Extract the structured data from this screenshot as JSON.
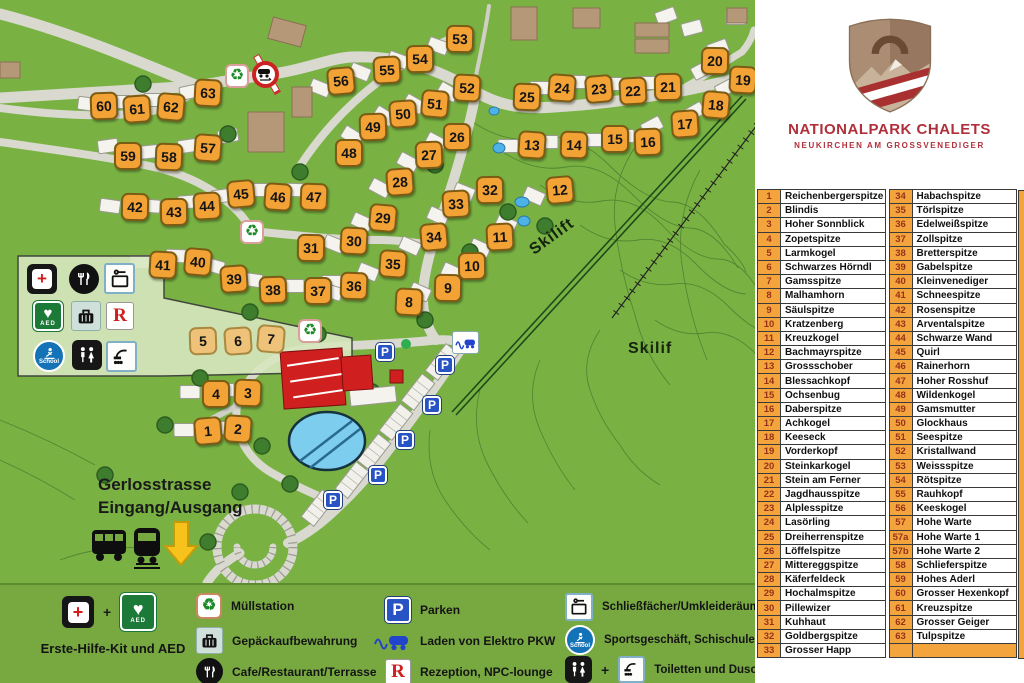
{
  "branding": {
    "title": "NATIONALPARK CHALETS",
    "subtitle": "NEUKIRCHEN AM GROSSVENEDIGER"
  },
  "chalet_table": {
    "left": [
      {
        "num": "1",
        "name": "Reichenbergerspitze"
      },
      {
        "num": "2",
        "name": "Blindis"
      },
      {
        "num": "3",
        "name": "Hoher Sonnblick"
      },
      {
        "num": "4",
        "name": "Zopetspitze"
      },
      {
        "num": "5",
        "name": "Larmkogel"
      },
      {
        "num": "6",
        "name": "Schwarzes Hörndl"
      },
      {
        "num": "7",
        "name": "Gamsspitze"
      },
      {
        "num": "8",
        "name": "Malhamhorn"
      },
      {
        "num": "9",
        "name": "Säulspitze"
      },
      {
        "num": "10",
        "name": "Kratzenberg"
      },
      {
        "num": "11",
        "name": "Kreuzkogel"
      },
      {
        "num": "12",
        "name": "Bachmayrspitze"
      },
      {
        "num": "13",
        "name": "Grossschober"
      },
      {
        "num": "14",
        "name": "Blessachkopf"
      },
      {
        "num": "15",
        "name": "Ochsenbug"
      },
      {
        "num": "16",
        "name": "Daberspitze"
      },
      {
        "num": "17",
        "name": "Achkogel"
      },
      {
        "num": "18",
        "name": "Keeseck"
      },
      {
        "num": "19",
        "name": "Vorderkopf"
      },
      {
        "num": "20",
        "name": "Steinkarkogel"
      },
      {
        "num": "21",
        "name": "Stein am Ferner"
      },
      {
        "num": "22",
        "name": "Jagdhausspitze"
      },
      {
        "num": "23",
        "name": "Alplesspitze"
      },
      {
        "num": "24",
        "name": "Lasörling"
      },
      {
        "num": "25",
        "name": "Dreiherrenspitze"
      },
      {
        "num": "26",
        "name": "Löffelspitze"
      },
      {
        "num": "27",
        "name": "Mittereggspitze"
      },
      {
        "num": "28",
        "name": "Käferfeldeck"
      },
      {
        "num": "29",
        "name": "Hochalmspitze"
      },
      {
        "num": "30",
        "name": "Pillewizer"
      },
      {
        "num": "31",
        "name": "Kuhhaut"
      },
      {
        "num": "32",
        "name": "Goldbergspitze"
      },
      {
        "num": "33",
        "name": "Grosser Happ"
      }
    ],
    "right": [
      {
        "num": "34",
        "name": "Habachspitze"
      },
      {
        "num": "35",
        "name": "Törlspitze"
      },
      {
        "num": "36",
        "name": "Edelweißspitze"
      },
      {
        "num": "37",
        "name": "Zollspitze"
      },
      {
        "num": "38",
        "name": "Bretterspitze"
      },
      {
        "num": "39",
        "name": "Gabelspitze"
      },
      {
        "num": "40",
        "name": "Kleinvenediger"
      },
      {
        "num": "41",
        "name": "Schneespitze"
      },
      {
        "num": "42",
        "name": "Rosenspitze"
      },
      {
        "num": "43",
        "name": "Arventalspitze"
      },
      {
        "num": "44",
        "name": "Schwarze Wand"
      },
      {
        "num": "45",
        "name": "Quirl"
      },
      {
        "num": "46",
        "name": "Rainerhorn"
      },
      {
        "num": "47",
        "name": "Hoher Rosshuf"
      },
      {
        "num": "48",
        "name": "Wildenkogel"
      },
      {
        "num": "49",
        "name": "Gamsmutter"
      },
      {
        "num": "50",
        "name": "Glockhaus"
      },
      {
        "num": "51",
        "name": "Seespitze"
      },
      {
        "num": "52",
        "name": "Kristallwand"
      },
      {
        "num": "53",
        "name": "Weissspitze"
      },
      {
        "num": "54",
        "name": "Rötspitze"
      },
      {
        "num": "55",
        "name": "Rauhkopf"
      },
      {
        "num": "56",
        "name": "Keeskogel"
      },
      {
        "num": "57",
        "name": "Hohe Warte"
      },
      {
        "num": "57a",
        "name": "Hohe Warte 1"
      },
      {
        "num": "57b",
        "name": "Hohe Warte 2"
      },
      {
        "num": "58",
        "name": "Schlieferspitze"
      },
      {
        "num": "59",
        "name": "Hohes Aderl"
      },
      {
        "num": "60",
        "name": "Grosser Hexenkopf"
      },
      {
        "num": "61",
        "name": "Kreuzspitze"
      },
      {
        "num": "62",
        "name": "Grosser Geiger"
      },
      {
        "num": "63",
        "name": "Tulpspitze"
      },
      {
        "num": "",
        "name": ""
      }
    ]
  },
  "map": {
    "labels": {
      "skilift": "Skilift",
      "skilif": "Skilif",
      "street": "Gerlosstrasse",
      "entrance": "Eingang/Ausgang"
    },
    "icons": {
      "recycle": "♻",
      "parking": "P",
      "heart": "♥",
      "aed": "AED",
      "school": "School",
      "reception": "R"
    },
    "muted": [
      "5",
      "6",
      "7"
    ],
    "plots": [
      {
        "n": "1",
        "x": 208,
        "y": 431
      },
      {
        "n": "2",
        "x": 238,
        "y": 429
      },
      {
        "n": "3",
        "x": 248,
        "y": 393
      },
      {
        "n": "4",
        "x": 216,
        "y": 394
      },
      {
        "n": "5",
        "x": 203,
        "y": 341
      },
      {
        "n": "6",
        "x": 238,
        "y": 341
      },
      {
        "n": "7",
        "x": 271,
        "y": 339
      },
      {
        "n": "8",
        "x": 409,
        "y": 302
      },
      {
        "n": "9",
        "x": 448,
        "y": 288
      },
      {
        "n": "10",
        "x": 472,
        "y": 266
      },
      {
        "n": "11",
        "x": 500,
        "y": 237
      },
      {
        "n": "12",
        "x": 560,
        "y": 190
      },
      {
        "n": "13",
        "x": 532,
        "y": 145
      },
      {
        "n": "14",
        "x": 574,
        "y": 145
      },
      {
        "n": "15",
        "x": 615,
        "y": 139
      },
      {
        "n": "16",
        "x": 648,
        "y": 142
      },
      {
        "n": "17",
        "x": 685,
        "y": 124
      },
      {
        "n": "18",
        "x": 716,
        "y": 105
      },
      {
        "n": "19",
        "x": 743,
        "y": 80
      },
      {
        "n": "20",
        "x": 715,
        "y": 61
      },
      {
        "n": "21",
        "x": 668,
        "y": 87
      },
      {
        "n": "22",
        "x": 633,
        "y": 91
      },
      {
        "n": "23",
        "x": 599,
        "y": 89
      },
      {
        "n": "24",
        "x": 562,
        "y": 88
      },
      {
        "n": "25",
        "x": 527,
        "y": 97
      },
      {
        "n": "26",
        "x": 457,
        "y": 137
      },
      {
        "n": "27",
        "x": 429,
        "y": 155
      },
      {
        "n": "28",
        "x": 400,
        "y": 182
      },
      {
        "n": "29",
        "x": 383,
        "y": 218
      },
      {
        "n": "30",
        "x": 354,
        "y": 241
      },
      {
        "n": "31",
        "x": 311,
        "y": 248
      },
      {
        "n": "32",
        "x": 490,
        "y": 190
      },
      {
        "n": "33",
        "x": 456,
        "y": 204
      },
      {
        "n": "34",
        "x": 434,
        "y": 237
      },
      {
        "n": "35",
        "x": 393,
        "y": 264
      },
      {
        "n": "36",
        "x": 354,
        "y": 286
      },
      {
        "n": "37",
        "x": 318,
        "y": 291
      },
      {
        "n": "38",
        "x": 273,
        "y": 290
      },
      {
        "n": "39",
        "x": 234,
        "y": 279
      },
      {
        "n": "40",
        "x": 198,
        "y": 262
      },
      {
        "n": "41",
        "x": 163,
        "y": 265
      },
      {
        "n": "42",
        "x": 135,
        "y": 207
      },
      {
        "n": "43",
        "x": 174,
        "y": 212
      },
      {
        "n": "44",
        "x": 207,
        "y": 206
      },
      {
        "n": "45",
        "x": 241,
        "y": 194
      },
      {
        "n": "46",
        "x": 278,
        "y": 197
      },
      {
        "n": "47",
        "x": 314,
        "y": 197
      },
      {
        "n": "48",
        "x": 349,
        "y": 153
      },
      {
        "n": "49",
        "x": 373,
        "y": 127
      },
      {
        "n": "50",
        "x": 403,
        "y": 114
      },
      {
        "n": "51",
        "x": 435,
        "y": 104
      },
      {
        "n": "52",
        "x": 467,
        "y": 88
      },
      {
        "n": "53",
        "x": 460,
        "y": 39
      },
      {
        "n": "54",
        "x": 420,
        "y": 59
      },
      {
        "n": "55",
        "x": 387,
        "y": 70
      },
      {
        "n": "56",
        "x": 341,
        "y": 81
      },
      {
        "n": "57",
        "x": 208,
        "y": 148
      },
      {
        "n": "58",
        "x": 169,
        "y": 157
      },
      {
        "n": "59",
        "x": 128,
        "y": 156
      },
      {
        "n": "60",
        "x": 104,
        "y": 106
      },
      {
        "n": "61",
        "x": 137,
        "y": 109
      },
      {
        "n": "62",
        "x": 171,
        "y": 107
      },
      {
        "n": "63",
        "x": 208,
        "y": 93
      }
    ],
    "parking": [
      [
        385,
        352
      ],
      [
        445,
        365
      ],
      [
        432,
        405
      ],
      [
        405,
        440
      ],
      [
        378,
        475
      ],
      [
        333,
        500
      ]
    ],
    "recycle": [
      [
        237,
        76
      ],
      [
        252,
        232
      ],
      [
        310,
        331
      ]
    ],
    "chalets": [
      [
        88,
        104,
        8
      ],
      [
        120,
        102,
        0
      ],
      [
        154,
        100,
        0
      ],
      [
        190,
        92,
        -12
      ],
      [
        108,
        146,
        -8
      ],
      [
        148,
        152,
        -6
      ],
      [
        188,
        146,
        -8
      ],
      [
        228,
        136,
        -10
      ],
      [
        320,
        88,
        22
      ],
      [
        360,
        72,
        22
      ],
      [
        398,
        60,
        20
      ],
      [
        438,
        46,
        20
      ],
      [
        352,
        136,
        32
      ],
      [
        384,
        116,
        32
      ],
      [
        414,
        104,
        30
      ],
      [
        448,
        92,
        30
      ],
      [
        110,
        206,
        8
      ],
      [
        150,
        206,
        4
      ],
      [
        188,
        202,
        -4
      ],
      [
        222,
        196,
        -8
      ],
      [
        258,
        190,
        0
      ],
      [
        296,
        190,
        2
      ],
      [
        140,
        262,
        0
      ],
      [
        176,
        256,
        2
      ],
      [
        214,
        266,
        16
      ],
      [
        252,
        280,
        8
      ],
      [
        294,
        286,
        0
      ],
      [
        332,
        282,
        0
      ],
      [
        540,
        88,
        0
      ],
      [
        576,
        82,
        0
      ],
      [
        612,
        84,
        0
      ],
      [
        646,
        83,
        0
      ],
      [
        702,
        70,
        -28
      ],
      [
        726,
        88,
        -28
      ],
      [
        694,
        112,
        -30
      ],
      [
        652,
        126,
        -28
      ],
      [
        624,
        136,
        0
      ],
      [
        592,
        140,
        0
      ],
      [
        548,
        142,
        0
      ],
      [
        508,
        146,
        0
      ],
      [
        436,
        142,
        28
      ],
      [
        408,
        162,
        28
      ],
      [
        380,
        188,
        28
      ],
      [
        362,
        222,
        24
      ],
      [
        334,
        244,
        22
      ],
      [
        464,
        192,
        22
      ],
      [
        438,
        216,
        24
      ],
      [
        410,
        246,
        24
      ],
      [
        368,
        272,
        22
      ],
      [
        332,
        292,
        18
      ],
      [
        420,
        292,
        24
      ],
      [
        452,
        272,
        24
      ],
      [
        480,
        248,
        24
      ],
      [
        506,
        224,
        24
      ],
      [
        534,
        196,
        24
      ],
      [
        190,
        392,
        0
      ],
      [
        224,
        390,
        0
      ],
      [
        184,
        430,
        0
      ],
      [
        218,
        428,
        0
      ],
      [
        666,
        16,
        -20
      ],
      [
        692,
        28,
        -15
      ],
      [
        718,
        48,
        -20
      ],
      [
        736,
        18,
        0
      ]
    ],
    "trees": [
      [
        143,
        84
      ],
      [
        228,
        134
      ],
      [
        300,
        172
      ],
      [
        250,
        312
      ],
      [
        318,
        334
      ],
      [
        200,
        378
      ],
      [
        165,
        425
      ],
      [
        262,
        446
      ],
      [
        290,
        484
      ],
      [
        372,
        392
      ],
      [
        425,
        320
      ],
      [
        435,
        165
      ],
      [
        470,
        252
      ],
      [
        508,
        212
      ],
      [
        545,
        226
      ],
      [
        240,
        492
      ],
      [
        208,
        542
      ],
      [
        105,
        475
      ]
    ],
    "parking_lots": [
      [
        352,
        480,
        -52
      ],
      [
        374,
        452,
        -52
      ],
      [
        396,
        422,
        -52
      ],
      [
        418,
        392,
        -52
      ],
      [
        442,
        362,
        -52
      ],
      [
        318,
        508,
        -52
      ]
    ]
  },
  "legend": {
    "plus": "+",
    "first_aid": "Erste-Hilfe-Kit und AED",
    "muellstation": "Müllstation",
    "gepaeck": "Gepäckaufbewahrung",
    "cafe": "Cafe/Restaurant/Terrasse",
    "parken": "Parken",
    "elektro": "Laden von Elektro PKW",
    "rezeption": "Rezeption, NPC-lounge",
    "schliess": "Schließfächer/Umkleideräume",
    "sport": "Sportsgeschäft, Schischule",
    "toiletten": "Toiletten und Duschen"
  },
  "colors": {
    "map_green": "#79b243",
    "legend_green": "#78a941",
    "plot_orange": "#f3a236",
    "table_orange": "#f4a43c",
    "brand_red": "#b02f3a",
    "pool_blue": "#7ccdee",
    "parking_blue": "#2753c5",
    "aed_green": "#1c7a38",
    "school_blue": "#1472b6"
  }
}
